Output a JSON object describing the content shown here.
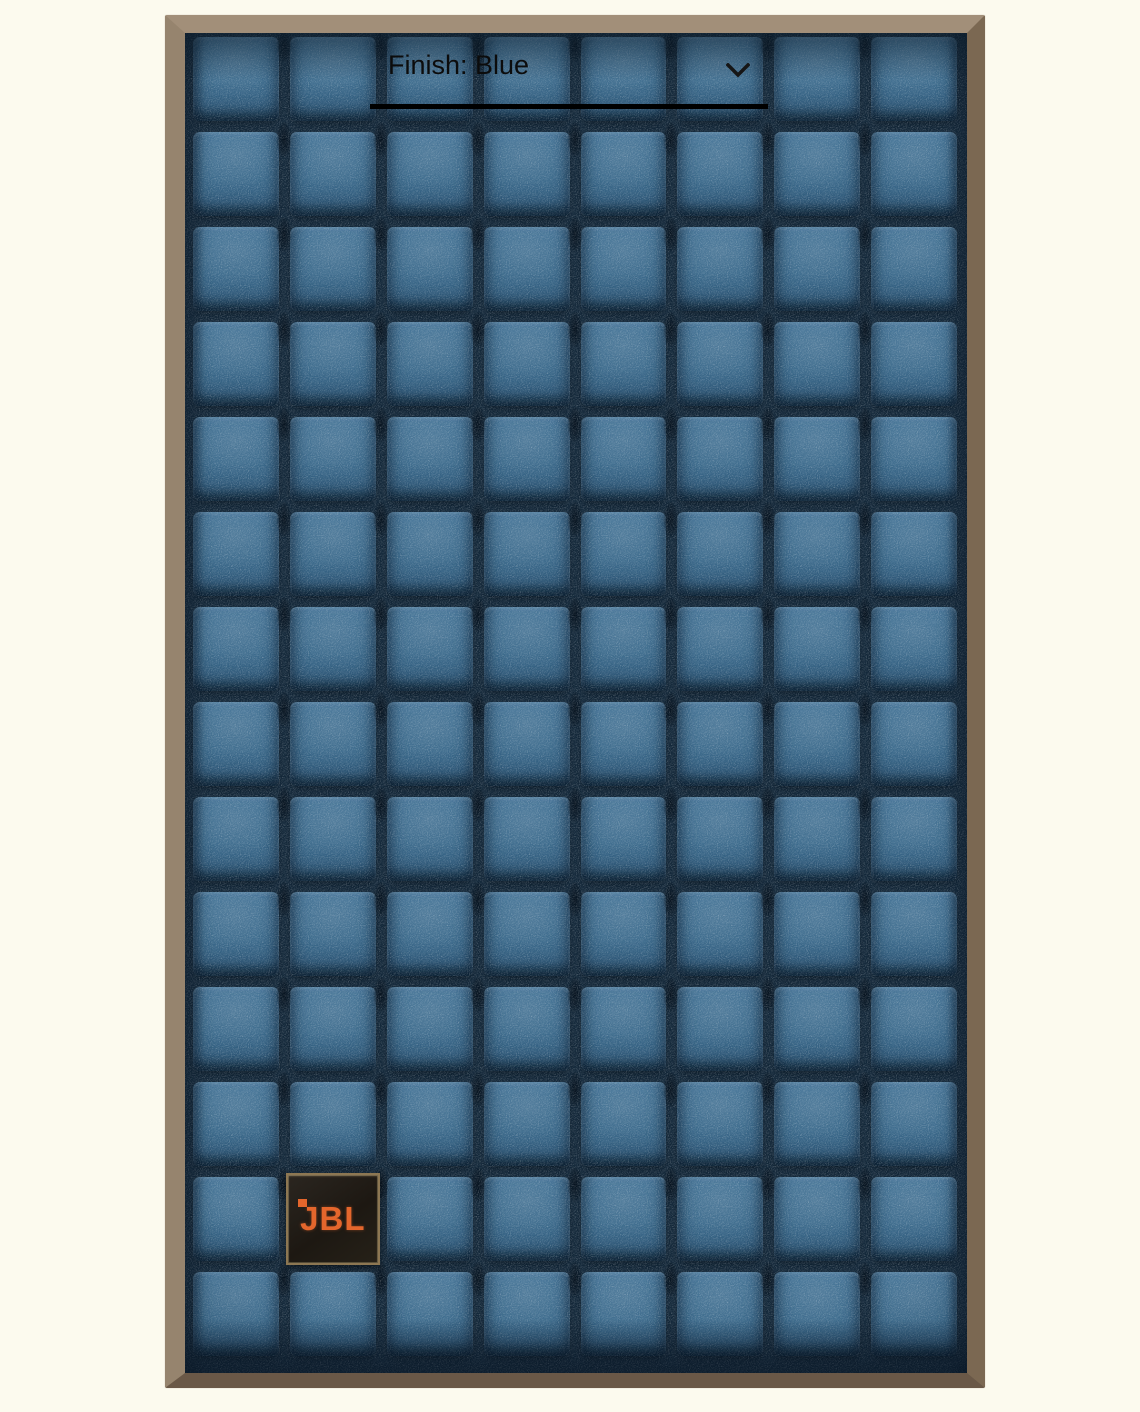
{
  "finish_selector": {
    "label": "Finish: Blue",
    "icon": "chevron-down-icon"
  },
  "product": {
    "brand_badge": "JBL",
    "grille": {
      "columns": 8,
      "rows": 14,
      "badge_cell": {
        "row": 13,
        "column": 2
      }
    },
    "colors": {
      "page_background": "#fcfaee",
      "foam_face": "#3b6a8c",
      "foam_groove": "#14293b",
      "frame_top": "#a28f79",
      "frame_left": "#96846e",
      "frame_right": "#7b6852",
      "frame_bottom": "#6a5847",
      "badge_background": "#1d1812",
      "badge_border": "#8d7752",
      "logo_orange": "#e4662c",
      "selector_text": "#0c0c0c",
      "selector_underline": "#000000"
    }
  }
}
